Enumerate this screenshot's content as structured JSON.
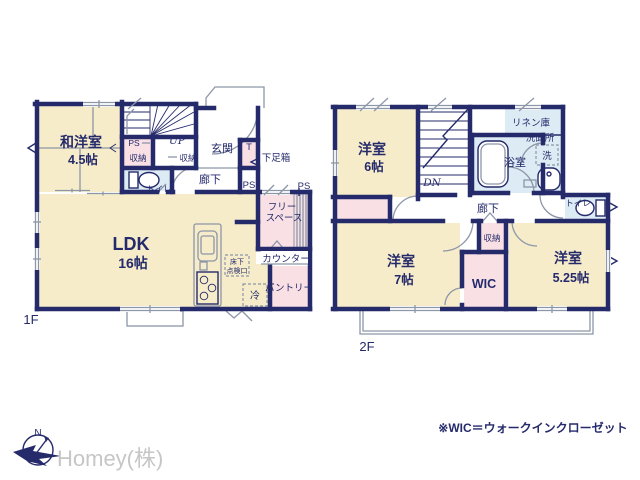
{
  "palette": {
    "wall_navy": "#252a6b",
    "room_cream": "#f6ecca",
    "closet_pink": "#f8e0e4",
    "wet_blue": "#dcebf4",
    "detail_gray": "#8d96a8",
    "logo_gray": "#c6c6c6"
  },
  "compass": {
    "north": "N"
  },
  "company": "Homey(株)",
  "footnote": "※WIC＝ウォークインクローゼット",
  "floor1": {
    "floor_label": "1F",
    "washitsu": {
      "name": "和洋室",
      "size": "4.5帖"
    },
    "ldk": {
      "name": "LDK",
      "size": "16帖"
    },
    "entrance": "玄関",
    "hallway": "廊下",
    "toilet": "トイレ",
    "stairs_up": "UP",
    "closet_a": "収納",
    "closet_b": "収納",
    "ps_a": "PS",
    "ps_b": "PS",
    "ps_c": "PS",
    "t_box": "T",
    "shoe_box": "下足箱",
    "free_space_1": "フリー",
    "free_space_2": "スペース",
    "counter": "カウンター",
    "pantry": "パントリー",
    "fridge": "冷",
    "floor_hatch_1": "床下",
    "floor_hatch_2": "点検口"
  },
  "floor2": {
    "floor_label": "2F",
    "bedroom6": {
      "name": "洋室",
      "size": "6帖"
    },
    "bedroom7": {
      "name": "洋室",
      "size": "7帖"
    },
    "bedroom525": {
      "name": "洋室",
      "size": "5.25帖"
    },
    "stairs_down": "DN",
    "bath": "浴室",
    "linen": "リネン庫",
    "washroom": "洗面所",
    "washer": "洗",
    "toilet": "トイレ",
    "hallway": "廊下",
    "closet": "収納",
    "wic": "WIC"
  }
}
